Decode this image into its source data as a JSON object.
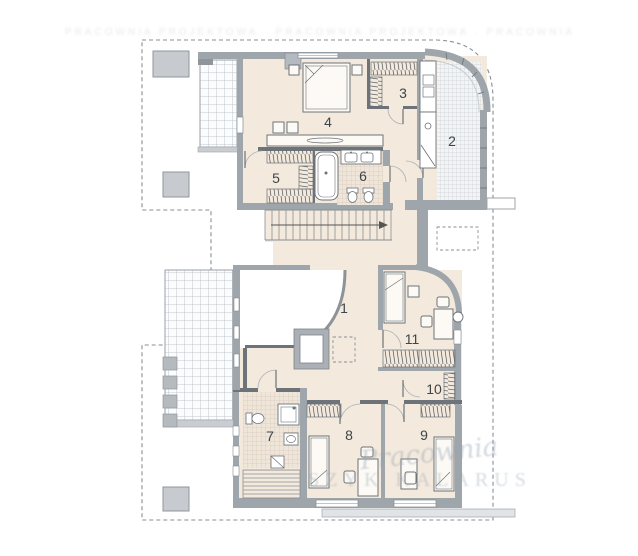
{
  "plan": {
    "type": "floor-plan",
    "floor_area_color": "#f3e9dc",
    "wall_color": "#9ea5ab",
    "wall_dark_color": "#6d7378",
    "label_color": "#3f4449"
  },
  "rooms": [
    {
      "label": "1"
    },
    {
      "label": "2"
    },
    {
      "label": "3"
    },
    {
      "label": "4"
    },
    {
      "label": "5"
    },
    {
      "label": "6"
    },
    {
      "label": "7"
    },
    {
      "label": "8"
    },
    {
      "label": "9"
    },
    {
      "label": "10"
    },
    {
      "label": "11"
    }
  ],
  "watermark": {
    "script": "Pracownia",
    "caps": "SZYK KALARUS",
    "top_smudge": "PRACOWNIA PROJEKTOWA · PRACOWNIA PROJEKTOWA · PRACOWNIA"
  }
}
